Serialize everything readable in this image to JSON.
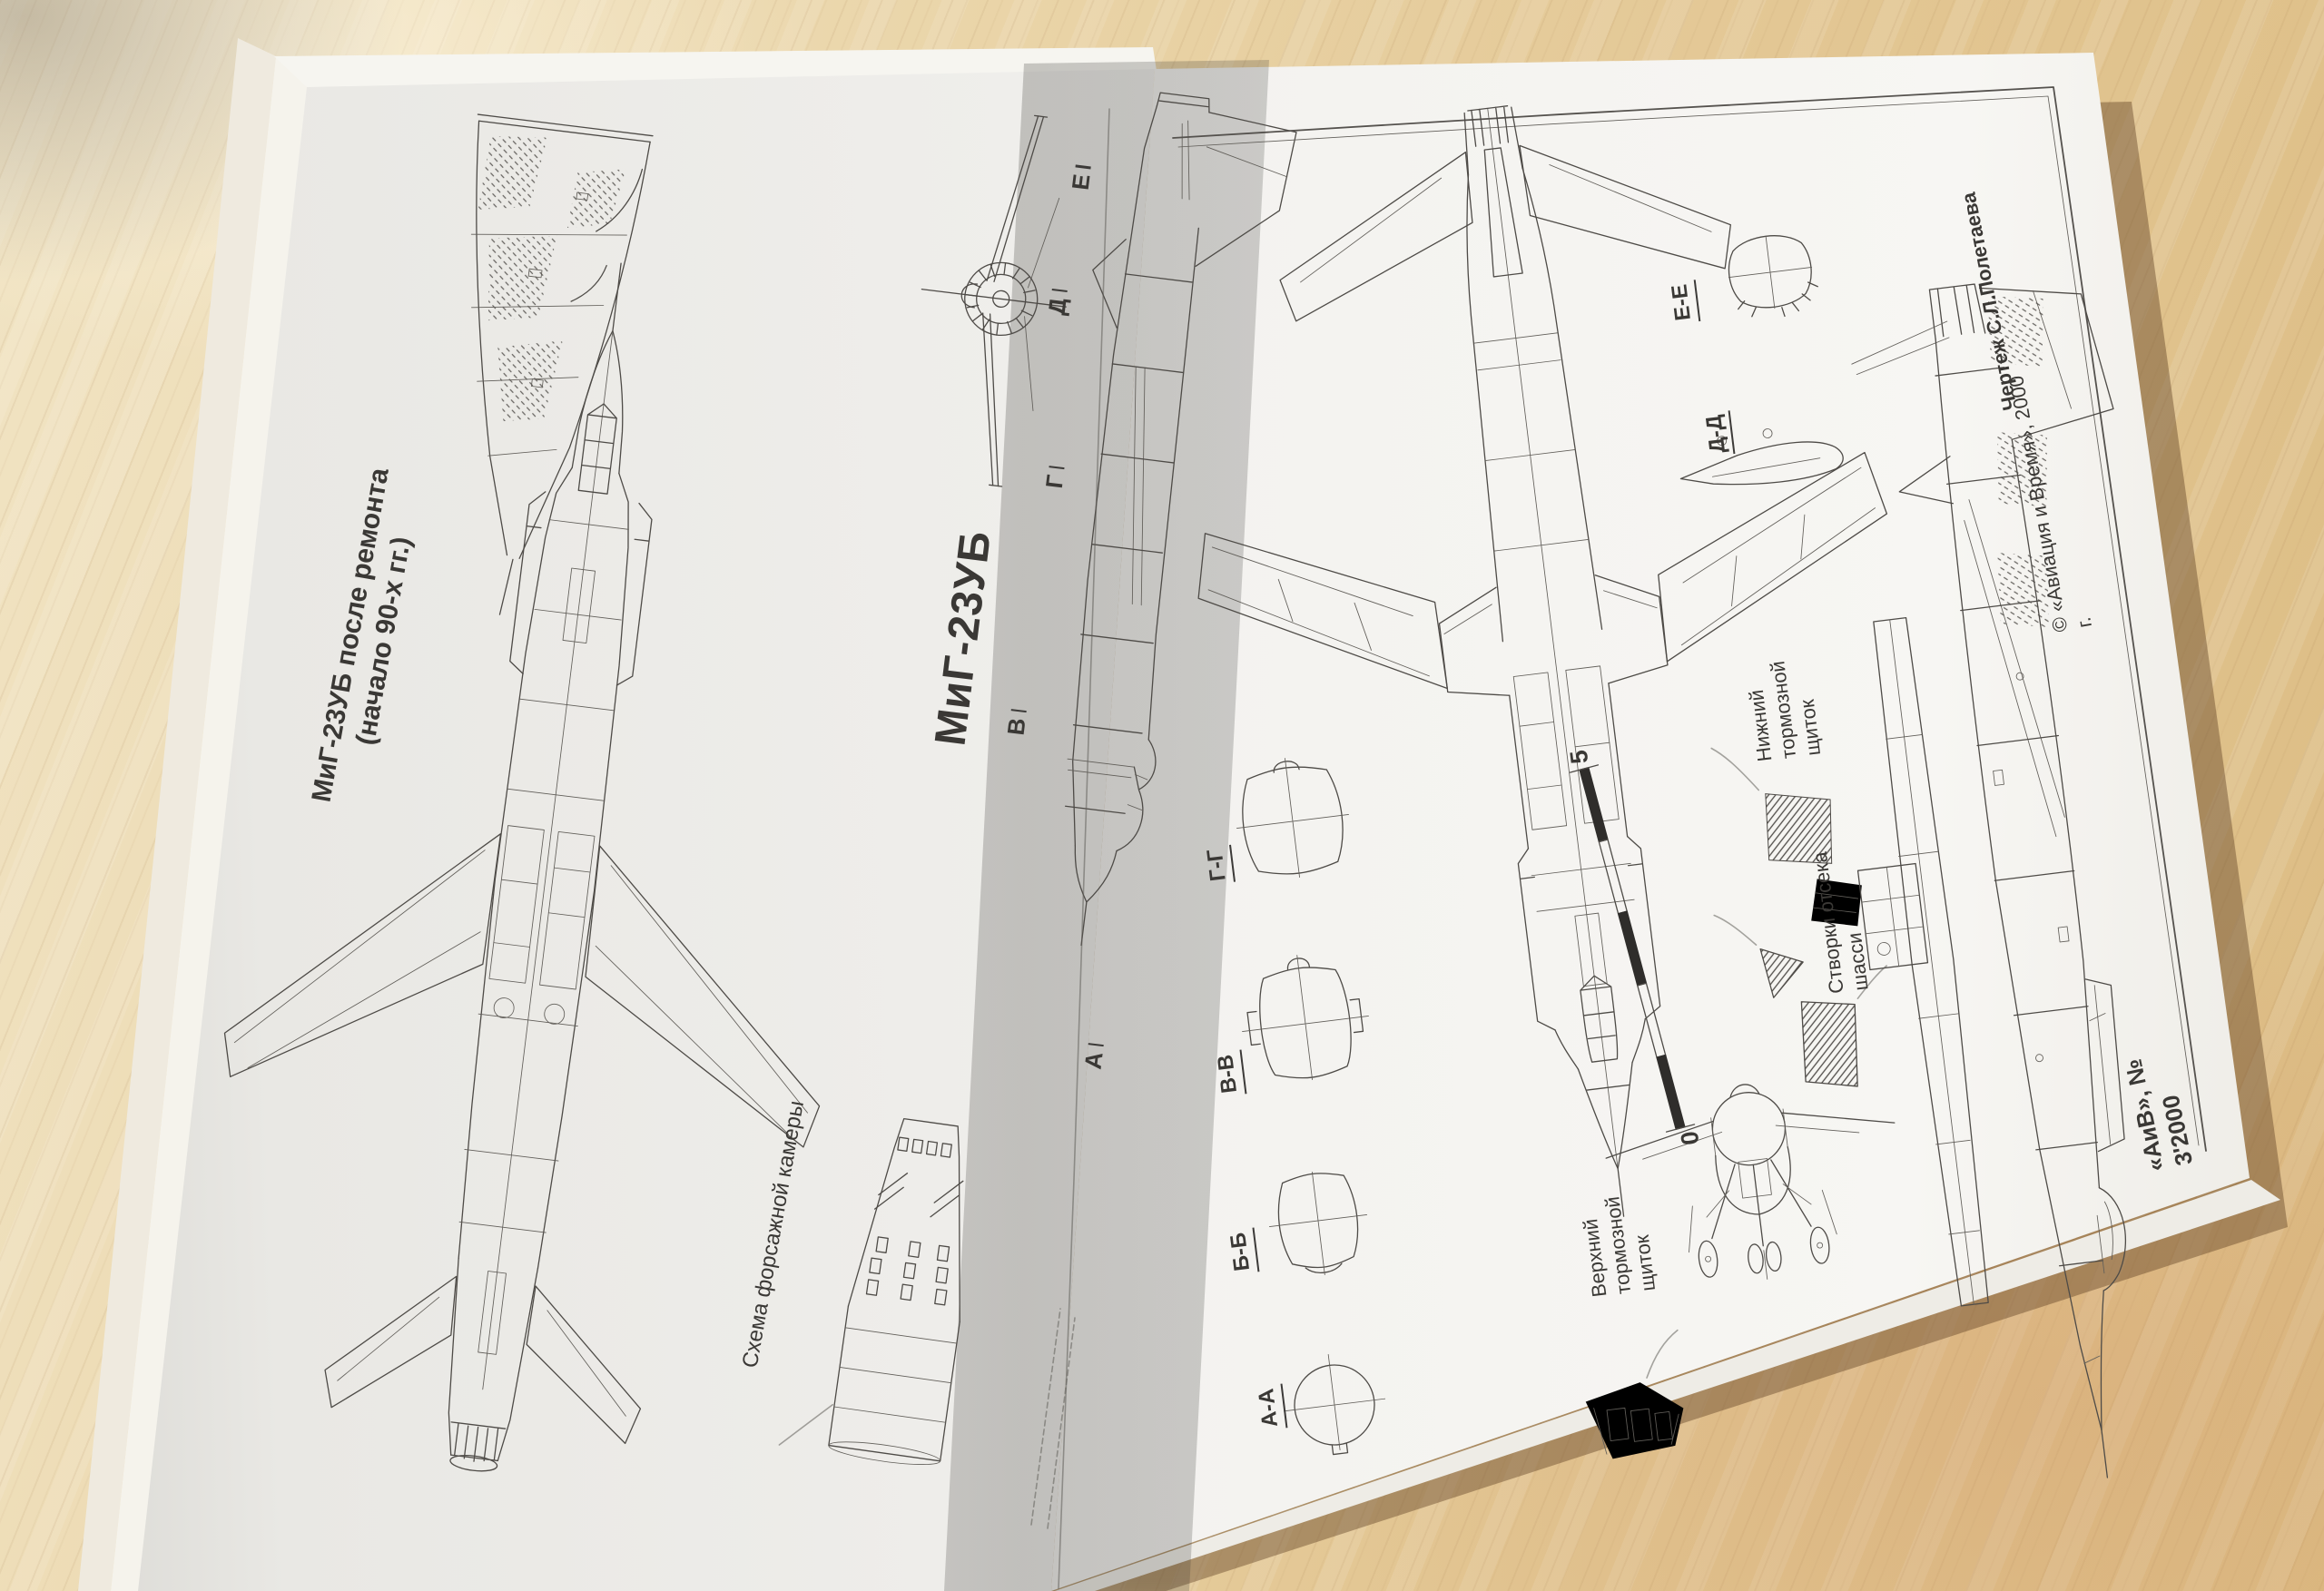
{
  "magazine": {
    "left_page": {
      "repair_caption": "МиГ-23УБ после ремонта\n(начало 90-х гг.)",
      "main_title": "МиГ-23УБ",
      "afterburner_caption": "Схема форсажной камеры",
      "section_markers": [
        "Е",
        "Д",
        "Г",
        "В",
        "А"
      ]
    },
    "right_page": {
      "drawing_credit": "Чертеж С.Л.Полетаева",
      "copyright_note": "© «Авиация и Время», 2000 г.",
      "issue_note": "«АиВ», № 3'2000",
      "cross_sections": [
        "А-А",
        "Б-Б",
        "В-В",
        "Г-Г",
        "Д-Д",
        "Е-Е"
      ],
      "callout_lower_airbrake": "Нижний\nтормозной\nщиток",
      "callout_gear_doors": "Створки отсека\nшасси",
      "callout_upper_airbrake": "Верхний\nтормозной\nщиток",
      "scale_max": "5",
      "scale_min": "0"
    },
    "colors": {
      "ink": "#3d3b38",
      "paper": "#f0efec",
      "wood": "#e6cd9e"
    }
  }
}
